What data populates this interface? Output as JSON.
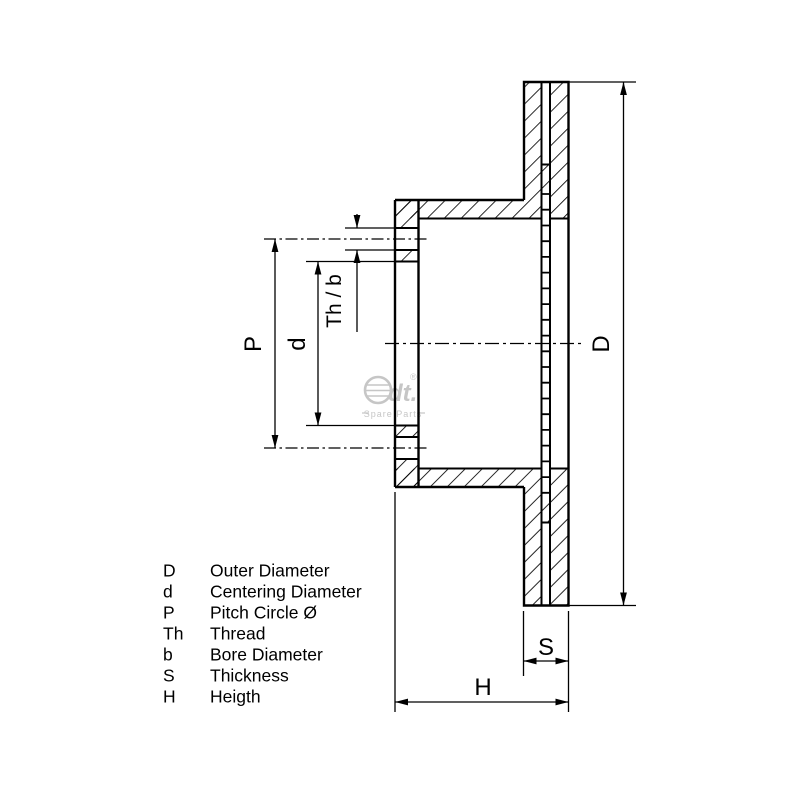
{
  "page": {
    "background": "#ffffff",
    "line_color": "#000000",
    "watermark_color": "#c6c6c6"
  },
  "dimensions": {
    "P": "P",
    "d": "d",
    "thb": "Th / b",
    "D": "D",
    "S": "S",
    "H": "H"
  },
  "legend": {
    "rows": [
      {
        "symbol": "D",
        "description": "Outer Diameter"
      },
      {
        "symbol": "d",
        "description": "Centering Diameter"
      },
      {
        "symbol": "P",
        "description": "Pitch Circle Ø"
      },
      {
        "symbol": "Th",
        "description": "Thread"
      },
      {
        "symbol": "b",
        "description": "Bore Diameter"
      },
      {
        "symbol": "S",
        "description": "Thickness"
      },
      {
        "symbol": "H",
        "description": "Heigth"
      }
    ]
  },
  "watermark": {
    "brand": "dt.",
    "registered": "®",
    "subtext": "Spare Parts"
  }
}
